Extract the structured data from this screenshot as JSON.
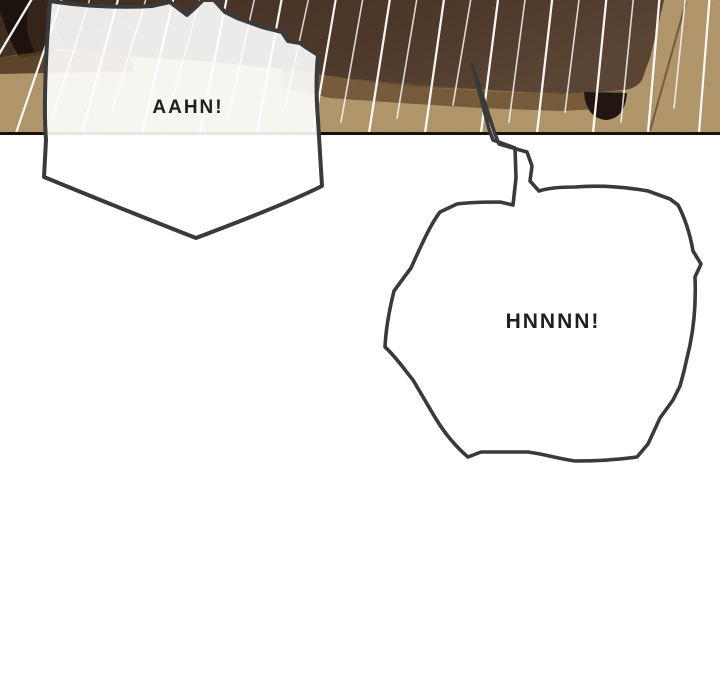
{
  "comic": {
    "page_background": "#ffffff",
    "panel": {
      "carpet_color": "#b1976b",
      "carpet_shadow_color": "#5f452a",
      "drapery_color": "#46331f",
      "drapery_dark_color": "#1a120c",
      "bed_knob_color": "#211710",
      "border_color": "#17120d",
      "speedline_color": "#ffffff"
    },
    "bubbles": [
      {
        "name": "bubble-aahn",
        "text": "AAHN!",
        "text_color": "#1f1f1f"
      },
      {
        "name": "bubble-hnnnn",
        "text": "HNNNN!",
        "text_color": "#1f1f1f"
      }
    ]
  }
}
